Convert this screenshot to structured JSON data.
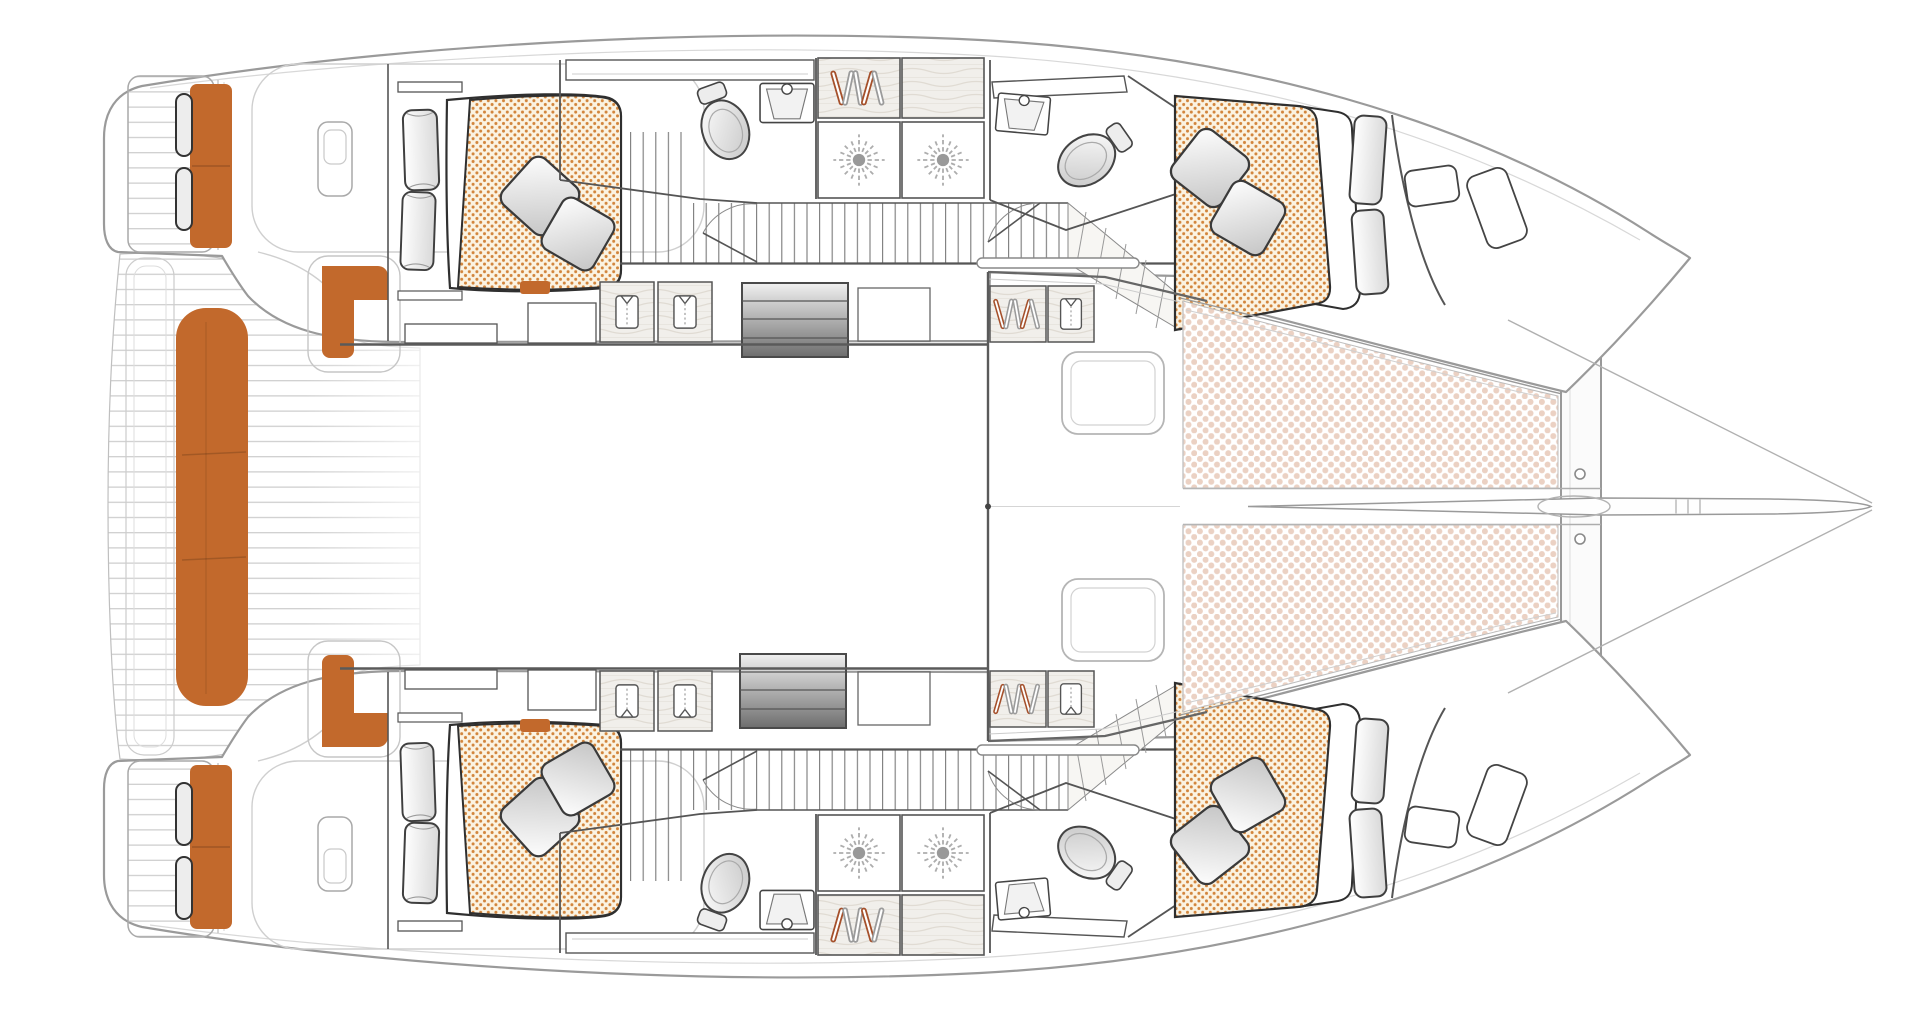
{
  "page": {
    "title": "Catamaran accommodation and deck floor plan, overhead view, bow pointing right",
    "background": "#ffffff"
  },
  "vessel": {
    "type": "sailing catamaran",
    "view": "top-down floor plan",
    "bow_direction": "right",
    "hulls": 2
  },
  "colors": {
    "accent": "#C2692C",
    "accent_deep": "#A9571F",
    "bed_bg": "#FBF3E2",
    "bed_dot": "#D2853C",
    "tramp_dot": "#EBD1C3",
    "wood_bg": "#F1EFEB",
    "wood_line": "#E0DBD3",
    "wall": "#555555",
    "furniture": "#3A3A3A",
    "hull_outline": "#9A9A9A",
    "deck_line": "#CBCBCB",
    "corridor_line": "#7A7A7A",
    "light_line": "#CFCFCF",
    "stair_light": "#F0F0F0",
    "stair_dark": "#6E6E6E",
    "pillow_hi": "#FFFFFF",
    "pillow_lo": "#C4C4C4",
    "cushion_lo": "#D9D9D9",
    "hanger_red": "#A5502B",
    "hanger_gray": "#9B9B9B"
  },
  "icons": [
    "toilet-icon",
    "sink-icon",
    "shower-head-icon",
    "clothes-hangers-icon",
    "folded-shirt-icon",
    "pillow-icon",
    "cushion-icon",
    "stairs-icon",
    "door-swing-icon"
  ],
  "features": {
    "double_beds": 4,
    "toilets": 4,
    "washbasins": 4,
    "shower_heads": 4,
    "hanging_lockers": 4,
    "folded_clothes_lockers": 6,
    "companionway_stairs": 2,
    "trampoline_panels": 2,
    "forward_cockpit_seats": 2,
    "aft_bench_seats": 1,
    "transom_sun_cushions": 2,
    "helm_corner_seats": 2,
    "bow_deck_hatches": 4,
    "bow_backrest_cushions": 4
  },
  "areas": [
    {
      "id": "aft-deck",
      "label": "Aft cockpit deck with teak planking"
    },
    {
      "id": "aft-bench",
      "label": "Aft centre bench"
    },
    {
      "id": "swim-platforms",
      "label": "Transom swim platforms with cushions"
    },
    {
      "id": "aft-cabin-port",
      "label": "Port aft double cabin"
    },
    {
      "id": "aft-cabin-starboard",
      "label": "Starboard aft double cabin"
    },
    {
      "id": "forward-cabin-port",
      "label": "Port forward double cabin"
    },
    {
      "id": "forward-cabin-starboard",
      "label": "Starboard forward double cabin"
    },
    {
      "id": "heads",
      "label": "Four bathrooms with toilet and basin"
    },
    {
      "id": "showers",
      "label": "Separate shower stalls"
    },
    {
      "id": "saloon",
      "label": "Bridgedeck saloon (open area)"
    },
    {
      "id": "forward-cockpit",
      "label": "Forward cockpit with two seats"
    },
    {
      "id": "trampolines",
      "label": "Bow trampolines"
    },
    {
      "id": "bowsprit",
      "label": "Central spar and bowsprit"
    }
  ]
}
